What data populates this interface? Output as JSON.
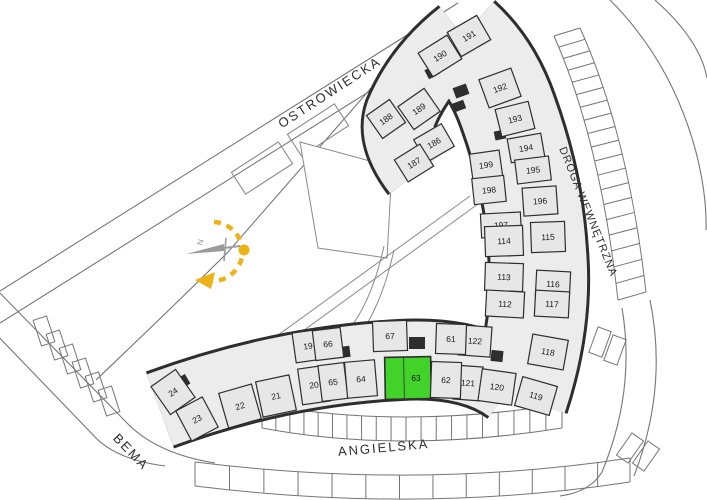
{
  "plan": {
    "type": "residential-site-plan",
    "selected_unit": "63"
  },
  "colors": {
    "background": "#ffffff",
    "building_fill": "#ececec",
    "cell_fill": "#e7e7e7",
    "wall": "#2e2e2e",
    "thin_line": "#757575",
    "path_line": "#8a8a8a",
    "selected_fill": "#42d32b",
    "unit_label": "#1a1a1a",
    "street_label": "#2f2f2f",
    "compass_yellow": "#ecb217",
    "compass_gray": "#9b9b9b"
  },
  "compass": {
    "label": "N"
  },
  "streets": [
    {
      "id": "ostrowiecka",
      "name": "OSTROWIECKA",
      "x": 332,
      "y": 96,
      "rotation": -33,
      "size": 13,
      "spacing": 2
    },
    {
      "id": "droga-wewnetrzna",
      "name": "DROGA WEWNĘTRZNA",
      "x": 585,
      "y": 213,
      "rotation": 68,
      "size": 11,
      "spacing": 1
    },
    {
      "id": "angielska",
      "name": "ANGIELSKA",
      "x": 384,
      "y": 452,
      "rotation": -5,
      "size": 13,
      "spacing": 2
    },
    {
      "id": "bema",
      "name": "BEMA",
      "x": 128,
      "y": 455,
      "rotation": 46,
      "size": 13,
      "spacing": 2
    }
  ],
  "units": [
    {
      "n": "190",
      "x": 440,
      "y": 56,
      "w": 34,
      "h": 28,
      "r": -32
    },
    {
      "n": "191",
      "x": 469,
      "y": 36,
      "w": 34,
      "h": 28,
      "r": -30
    },
    {
      "n": "192",
      "x": 500,
      "y": 88,
      "w": 34,
      "h": 30,
      "r": -20
    },
    {
      "n": "193",
      "x": 515,
      "y": 119,
      "w": 34,
      "h": 28,
      "r": -14
    },
    {
      "n": "194",
      "x": 526,
      "y": 148,
      "w": 34,
      "h": 24,
      "r": -10
    },
    {
      "n": "195",
      "x": 533,
      "y": 170,
      "w": 34,
      "h": 24,
      "r": -7
    },
    {
      "n": "196",
      "x": 540,
      "y": 201,
      "w": 34,
      "h": 28,
      "r": -4
    },
    {
      "n": "199",
      "x": 486,
      "y": 165,
      "w": 30,
      "h": 26,
      "r": -8
    },
    {
      "n": "198",
      "x": 489,
      "y": 190,
      "w": 32,
      "h": 26,
      "r": -6
    },
    {
      "n": "197",
      "x": 501,
      "y": 225,
      "w": 40,
      "h": 24,
      "r": -3
    },
    {
      "n": "188",
      "x": 386,
      "y": 119,
      "w": 28,
      "h": 28,
      "r": -35
    },
    {
      "n": "189",
      "x": 419,
      "y": 109,
      "w": 32,
      "h": 28,
      "r": -35
    },
    {
      "n": "186",
      "x": 434,
      "y": 143,
      "w": 32,
      "h": 26,
      "r": -30
    },
    {
      "n": "187",
      "x": 414,
      "y": 163,
      "w": 30,
      "h": 26,
      "r": -32
    },
    {
      "n": "114",
      "x": 504,
      "y": 241,
      "w": 38,
      "h": 30,
      "r": -2
    },
    {
      "n": "115",
      "x": 548,
      "y": 237,
      "w": 34,
      "h": 30,
      "r": -2
    },
    {
      "n": "113",
      "x": 504,
      "y": 277,
      "w": 38,
      "h": 28,
      "r": 2
    },
    {
      "n": "116",
      "x": 553,
      "y": 284,
      "w": 34,
      "h": 26,
      "r": 3
    },
    {
      "n": "112",
      "x": 505,
      "y": 304,
      "w": 38,
      "h": 26,
      "r": 3
    },
    {
      "n": "117",
      "x": 552,
      "y": 304,
      "w": 34,
      "h": 26,
      "r": 3
    },
    {
      "n": "122",
      "x": 475,
      "y": 341,
      "w": 32,
      "h": 30,
      "r": 4
    },
    {
      "n": "118",
      "x": 548,
      "y": 352,
      "w": 36,
      "h": 30,
      "r": 10
    },
    {
      "n": "121",
      "x": 468,
      "y": 383,
      "w": 28,
      "h": 34,
      "r": 4
    },
    {
      "n": "120",
      "x": 497,
      "y": 387,
      "w": 34,
      "h": 32,
      "r": 8
    },
    {
      "n": "119",
      "x": 536,
      "y": 396,
      "w": 36,
      "h": 30,
      "r": 16
    },
    {
      "n": "19",
      "x": 308,
      "y": 346,
      "w": 28,
      "h": 30,
      "r": -8
    },
    {
      "n": "66",
      "x": 328,
      "y": 344,
      "w": 28,
      "h": 30,
      "r": -7
    },
    {
      "n": "67",
      "x": 390,
      "y": 336,
      "w": 34,
      "h": 30,
      "r": -2
    },
    {
      "n": "61",
      "x": 451,
      "y": 339,
      "w": 30,
      "h": 30,
      "r": 2
    },
    {
      "n": "24",
      "x": 173,
      "y": 392,
      "w": 30,
      "h": 34,
      "r": -35
    },
    {
      "n": "23",
      "x": 197,
      "y": 419,
      "w": 30,
      "h": 34,
      "r": -28
    },
    {
      "n": "22",
      "x": 240,
      "y": 406,
      "w": 34,
      "h": 36,
      "r": -16
    },
    {
      "n": "21",
      "x": 276,
      "y": 396,
      "w": 34,
      "h": 36,
      "r": -12
    },
    {
      "n": "20",
      "x": 314,
      "y": 385,
      "w": 28,
      "h": 36,
      "r": -8
    },
    {
      "n": "65",
      "x": 333,
      "y": 382,
      "w": 26,
      "h": 36,
      "r": -7
    },
    {
      "n": "64",
      "x": 361,
      "y": 379,
      "w": 30,
      "h": 36,
      "r": -5
    },
    {
      "n": "63",
      "x": 408,
      "y": 378,
      "w": 46,
      "h": 42,
      "r": -1,
      "sel": true,
      "lx": 8
    },
    {
      "n": "62",
      "x": 446,
      "y": 380,
      "w": 30,
      "h": 36,
      "r": 2
    }
  ]
}
